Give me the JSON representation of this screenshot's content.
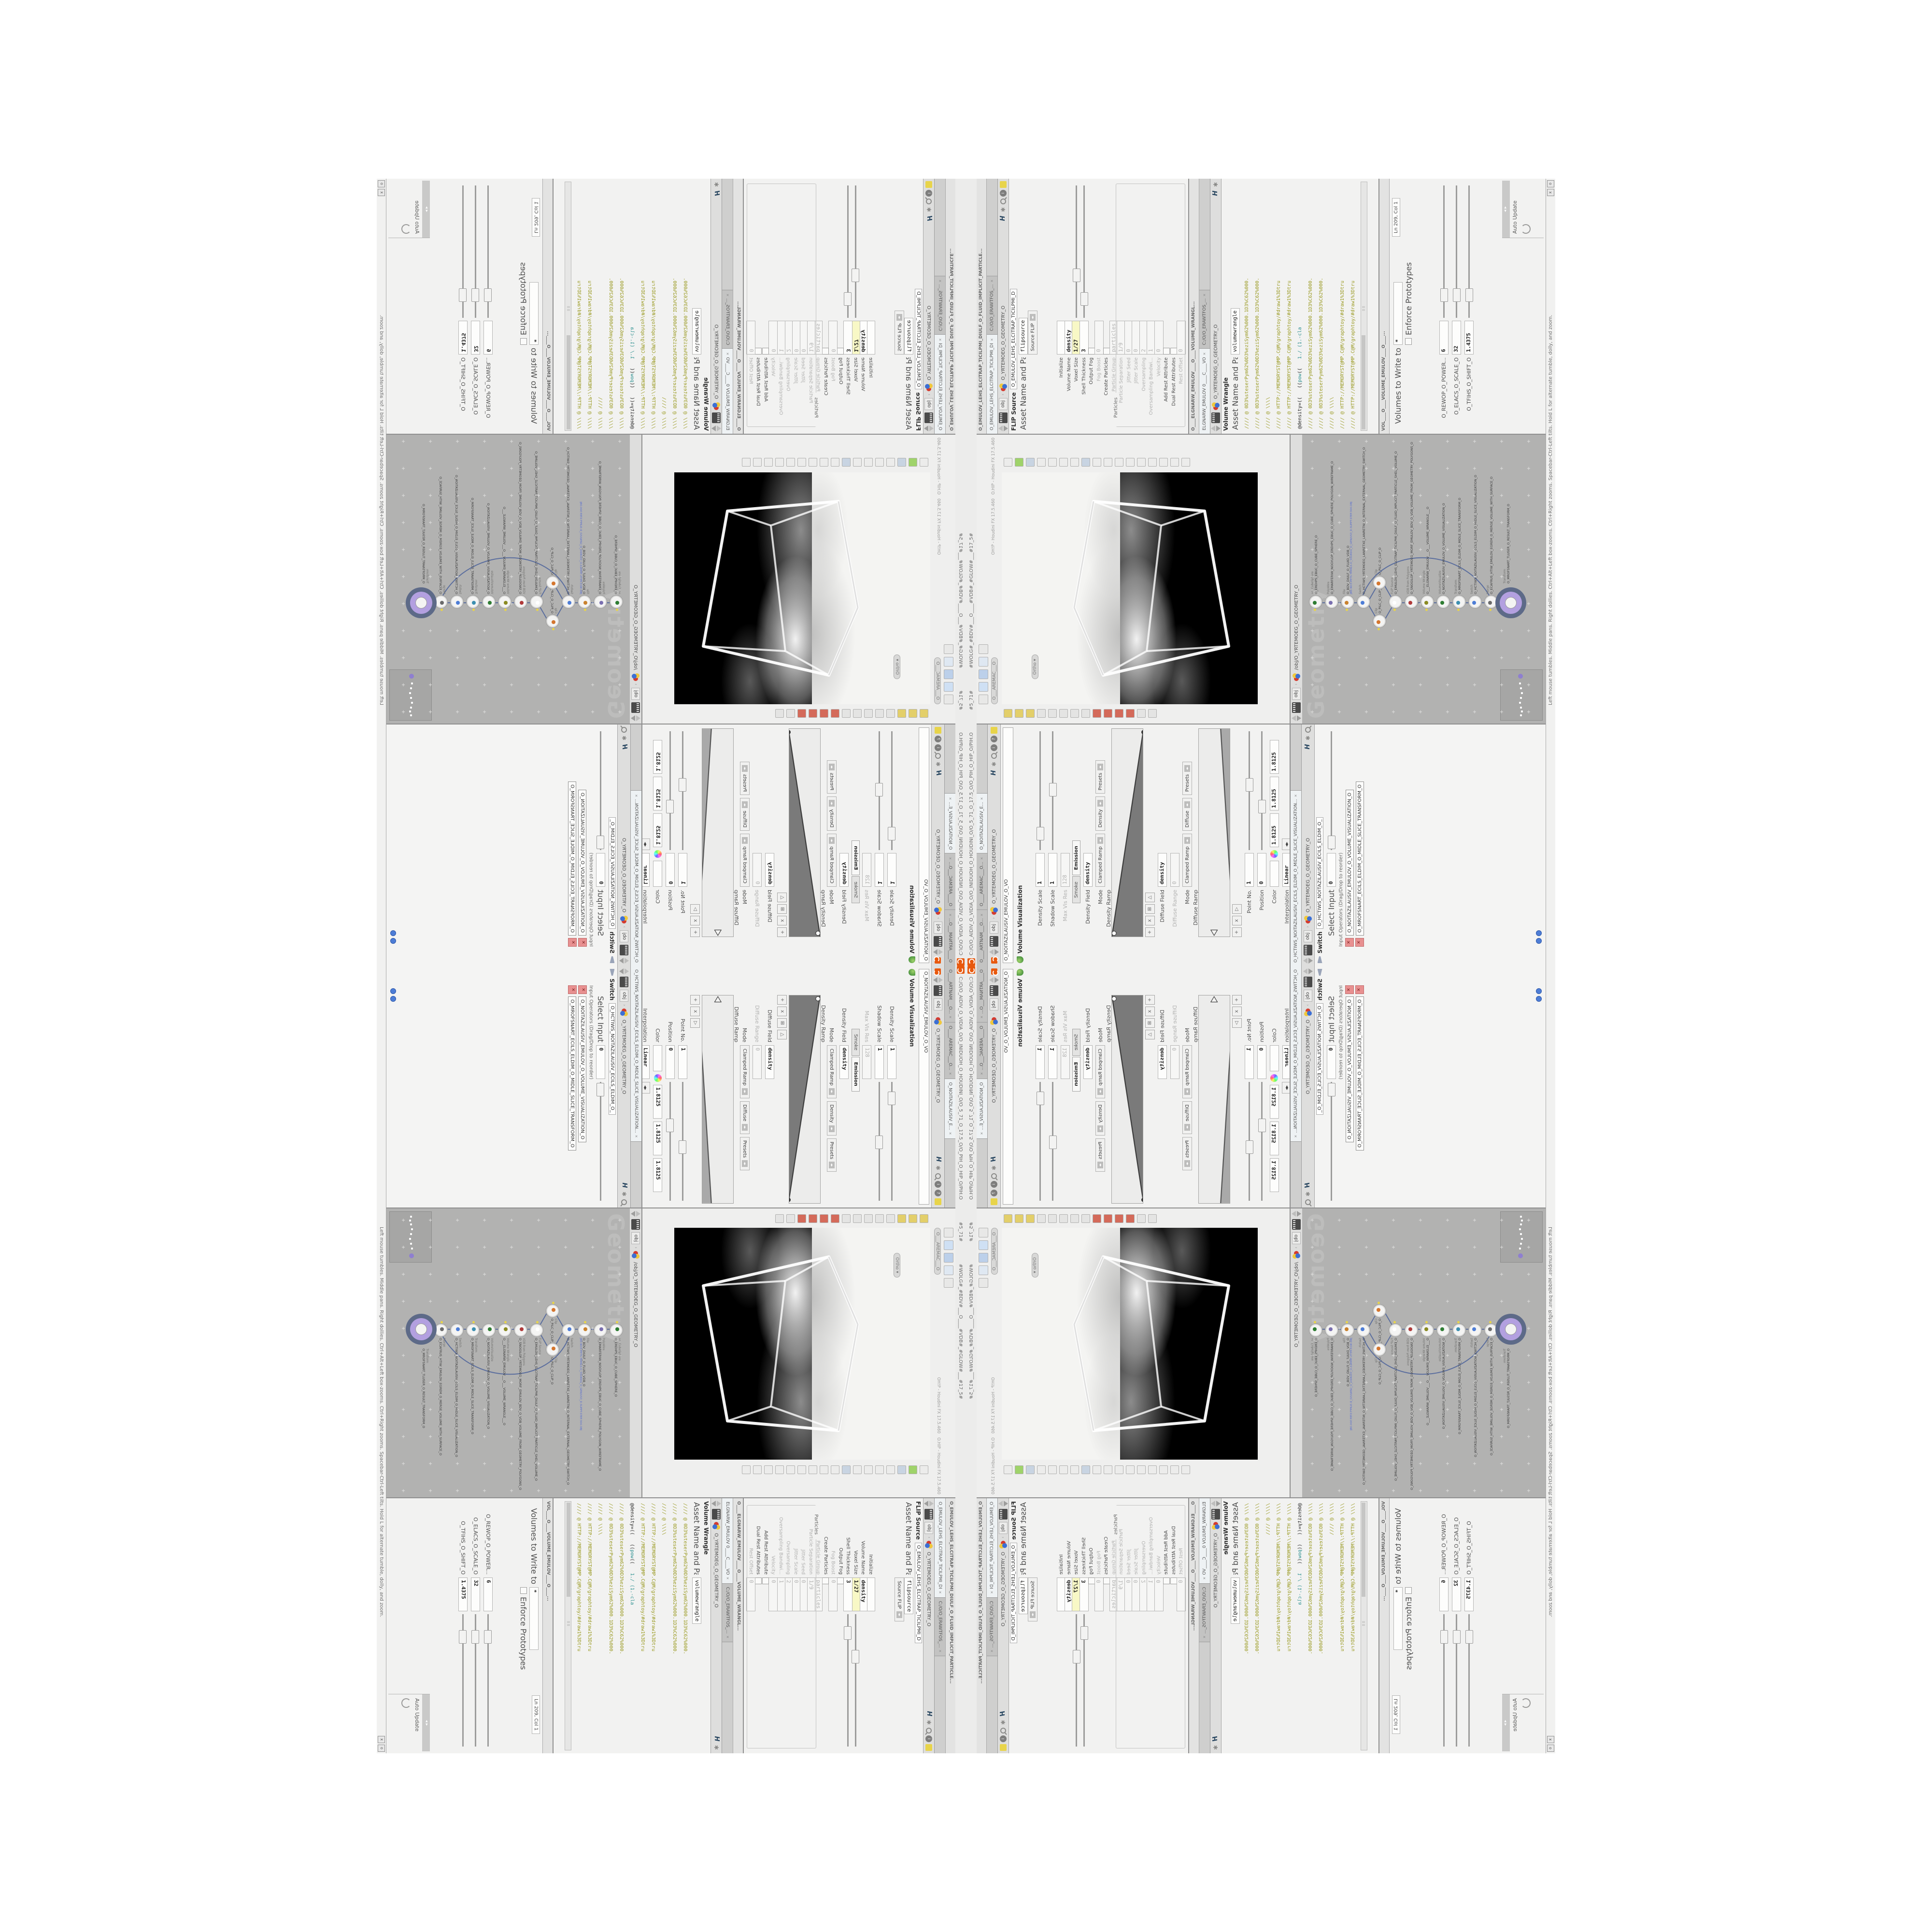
{
  "title_bar": {
    "path": "C:/O/O_AIDIV_O_VIDIA_O/O_INIDUOH_O_HOUDINI_O/O_5_71_O_17.5_O/O_PIH_O_HIP_O/PIH.O",
    "frame_tag": "#5_71#",
    "flags_tag": "#WOLG#_#BDV#___O____#VDB#_#GLOW#___#17_5#"
  },
  "status_bar": {
    "help_text": "Left mouse tumbles. Middle pans. Right dollies. Ctrl+Alt+Left box-zooms. Ctrl+Right zooms. Spacebar-Ctrl-Left tilts. Hold L for alternate tumble, dolly, and zoom.",
    "close_label": "x",
    "restore_label": "o"
  },
  "viz_pane": {
    "tabs": [
      "O____ARTNAM___O...",
      "O____AREMAC___O...",
      "O_NOITAZILAUSIV_E..."
    ],
    "path_context": "obj",
    "path_node": "O_YRTEMOEG_O_GEOMETRY_O",
    "name_field": "O_NOITAZILAUSIV_EMULOV_O_VO",
    "header": "Volume Visualization",
    "rows": [
      {
        "label": "Density Scale",
        "value": "1",
        "type": "slider"
      },
      {
        "label": "Shadow Scale",
        "value": "1",
        "type": "slider"
      },
      {
        "label": "Max Vis Res",
        "value": "128",
        "type": "dim"
      },
      {
        "label": "",
        "type": "tabs",
        "tabs": [
          "Smoke",
          "Emission"
        ],
        "active": 1
      },
      {
        "label": "Density Field",
        "value": "density",
        "type": "value"
      },
      {
        "label": "Mode",
        "type": "mode",
        "opts": [
          "Clamped Ramp",
          "Density",
          "Presets"
        ]
      },
      {
        "label": "Density Ramp",
        "type": "ramp",
        "ramp": "density"
      },
      {
        "label": "",
        "type": "btns",
        "btns": [
          "+",
          "x",
          "⊞",
          "△"
        ]
      },
      {
        "label": "Diffuse Field",
        "value": "density",
        "type": "value"
      },
      {
        "label": "Diffuse Range",
        "value": "0",
        "type": "dim"
      },
      {
        "label": "Mode",
        "type": "mode",
        "opts": [
          "Clamped Ramp",
          "Diffuse",
          "Presets"
        ]
      },
      {
        "label": "Diffuse Ramp",
        "type": "ramp",
        "ramp": "diffuse"
      },
      {
        "label": "",
        "type": "btns",
        "btns": [
          "+",
          "x",
          "▷"
        ]
      },
      {
        "label": "Point No.",
        "value": "1",
        "type": "slider"
      },
      {
        "label": "Position",
        "value": "0",
        "type": "slider"
      },
      {
        "label": "Color",
        "type": "color",
        "rgb": [
          "1.8125",
          "1.8125",
          "1.8125"
        ]
      },
      {
        "label": "Interpolation",
        "value": "Linear",
        "type": "dropdown"
      }
    ]
  },
  "switch_pane": {
    "tab": "O_HCTIWS_NOITAZILAUSIV_ECILS_ELDIM_O_MIDLE_SLICE_VISUALIZATION...",
    "path_context": "obj",
    "path_node": "O_YRTEMOEG_O_GEOMETRY_O",
    "header": "Switch",
    "name_field": "O_HCTIWS_NOITAZILAUSIV_ECILS_ELDIM_O_",
    "select_input_label": "Select Input",
    "select_input_value": "0",
    "input_operators_label": "Input Operators (Drag/Drop to reorder)",
    "items": [
      "O_NOITAZILAUSIV_EMULOV_O_VOLUME_VISUALIZATION_O",
      "O_MROFSNART_ECILS_ELDIM_O_MIDLE_SLICE_TRANSFORM_O"
    ]
  },
  "viewport": {
    "camera_pill": "O___AREMAC___O",
    "projection_pill": "Ortho",
    "hud_line_1": "OH!P - Houdini FX 17.5.460",
    "hud_line_2": "O.HIP - Houdini FX 17.5.460"
  },
  "network": {
    "path": "/obj/O_YRTEMOEG_O_GEOMETRY_O",
    "context_badge": "obj",
    "watermark": "Geometry",
    "nodes": [
      {
        "type": "an_CubeSphere",
        "name": "O_EREHPS_EBUC_O_CUBE_SPHERE_O",
        "glyph": "#2e7d32"
      },
      {
        "type": "PolyWire",
        "name": "O_EMARFERIW_NOGYLOP_EREHPS_EBUC_O_CUBE_SPHERE_POLYGON_WIREFRAME_O",
        "glyph": "#7a6fb0"
      },
      {
        "type": "File",
        "name": "O_BDV_DIULF_O_FLUID_VDB_O",
        "sub": "JBD.NO3.PETS.TRPALS.O_5SURDG_O_GEN/US3_D.SUPPT.STEP.304.OBJ",
        "glyph": "#c9822f"
      },
      {
        "type": "Switch",
        "name": "O_HCTIWS_YRTEMOEG_LANRETXE_LANRETNI_O_INTERNAL_EXTERNAL_GEOMETRY_SWITCH_O",
        "glyph": "#4d7dd6"
      },
      {
        "type": "Clip",
        "name": "O_PILC_O_CLIP_O",
        "glyph": "#d4762f"
      },
      {
        "type": "Clip",
        "name": "O_PILC_O_CLIP_O",
        "glyph": "#d4762f"
      },
      {
        "type": "FLIP Source",
        "name": "O_EMULOV_LEHS_ELCITRAP_TICILPMI_DIULF_O_FLUID_IMPLICIT_PARTICLE_SHEL_VOLUME_O",
        "glyph": "#ffffff"
      },
      {
        "type": "VDB from Polygons",
        "name": "O_SNOGILOP_YRTEMOEG_MORF_EMULOV_BDV_O_VDB_VOLUME_FROM_GEOMETRY_POLYGONS_O",
        "glyph": "#b03a3a"
      },
      {
        "type": "Volume Wrangle",
        "name": "O___ELGNARW_EMULOV___O___VOLUME_WRANGLE___O",
        "glyph": "#8a8a22"
      },
      {
        "type": "VolumeVisualize",
        "name": "O_NOITAZILAUSIV_EMULOV_O_VOLUME_VISUALIZATION_O",
        "glyph": "#2e7d32"
      },
      {
        "type": "Transform",
        "name": "O_MROFSNART_ECILS_ELDIM_O_MIDLE_SLICE_TRANSFORM_O",
        "glyph": "#3c8fb0"
      },
      {
        "type": "Switch",
        "name": "O_HCTIWS_NOITAZILAUSIV_ECILS_ELDIM_O_MIDLE_SLICE_VISUALIZATION_O",
        "glyph": "#4d7dd6"
      },
      {
        "type": "Merge",
        "name": "O_ECAFRUS_HTIW_EMULOV_EGREM_O_MERGE_VOLUME_WITH_SURFACE_O",
        "glyph": "#6a6a6a"
      },
      {
        "type": "Transform",
        "name": "O_MROFSNART_TLUSER_O_RESULT_TRANSFORM_O",
        "glyph": "#3c8fb0",
        "selected": true
      }
    ]
  },
  "flip_pane": {
    "window_title": "O_EMULOV_LEHS_ELCITRAP_TICILPMI_DIULF_O_FLUID_IMPLICIT_PARTICLE...",
    "tab1": "O_EMULOV_LEHS_ELCITRAP_TICILPMI_DI",
    "tab2": "C:/O/O_ERAWTFOS_...",
    "path_context": "obj",
    "path_node": "O_YRTEMOEG_O_GEOMETRY_O",
    "header": "FLIP Source",
    "header_field": "O_EMULOV_LEHS_ELCITRAP_TICILPMI_D",
    "asset_label": "Asset Name and Path",
    "asset_value": "flipsource",
    "preset_button": "Source FLIP",
    "rows": [
      {
        "label": "Initialize",
        "value": "",
        "type": "value"
      },
      {
        "label": "Volume Name",
        "value": "density",
        "type": "value"
      },
      {
        "label": "Voxel Size",
        "value": "1/27",
        "type": "yellow"
      },
      {
        "label": "Shell Thickness",
        "value": "3",
        "type": "slider"
      },
      {
        "label": "Output Fog",
        "type": "check"
      },
      {
        "label": "Fog Boost",
        "value": "0",
        "type": "dim"
      },
      {
        "label": "Create Particles",
        "type": "check"
      },
      {
        "label": "Particle Group",
        "value": "particles",
        "type": "dim"
      },
      {
        "label": "Particle Separation",
        "value": "1/9",
        "type": "dim"
      },
      {
        "label": "Jitter Seed",
        "value": "0",
        "type": "dim"
      },
      {
        "label": "Jitter Scale",
        "value": "0",
        "type": "dim"
      },
      {
        "label": "Oversampling",
        "value": "2",
        "type": "dim"
      },
      {
        "label": "Oversampling Bandwi...",
        "value": "1",
        "type": "dim"
      },
      {
        "label": "Velocity",
        "value": "0",
        "type": "dim"
      },
      {
        "label": "Add Rest Attribute",
        "type": "check"
      },
      {
        "label": "Dual Rest Attributes",
        "type": "check"
      },
      {
        "label": "Rest Offset",
        "value": "0",
        "type": "dim"
      }
    ],
    "group_label": "Particles"
  },
  "wrangle_pane": {
    "window_title": "O____ELGNARW_EMULOV____O____VOLUME_WRANGL...",
    "tab1": "ELGNARW_EMULOV 0____C____VO",
    "tab2": "C:/O/O_ERAWTFOS_...",
    "path_node": "O_YRTEMOEG_O_GEOMETRY_O",
    "header": "Volume Wrangle",
    "asset_label": "Asset Name and Path",
    "asset_value": "volumewrangle",
    "code_lines": [
      "//// @ 0D3%steserPym62%0D3%eziSym62%000.1D3%C62%000.",
      "//// @ 0D3%steserPym62%0D3%eziSym62%000.1D3%C62%000.",
      "//// @ \\\\\\\\",
      "//// @ HTTP://MEMORYST@MP.C@M/graphtoy/#draw1%3Dtru",
      "//// @ HTTP://MEMORYST@MP.C@M/graphtoy/#draw1%3Dtru",
      "@density=((   ((pow((   1./ (1.-cla",
      "//// @ 0D3%steserPym62%0D3%eziSym62%000.1D3%C62%000.",
      "//// @ 0D3%steserPym62%0D3%eziSym62%000.1D3%C62%000.",
      "//// @ \\\\\\\\",
      "//// @ HTTP://MEMORYST@MP.C@M/graphtoy/#draw1%3Dtru",
      "//// @ HTTP://MEMORYST@MP.C@M/graphtoy/#draw1%3Dtru"
    ]
  },
  "textport_pane": {
    "window_title": "VOL____O____VOLUME_EMULOV____O____...",
    "volumes_label": "Volumes to Write to",
    "volumes_value": "*",
    "enforce_label": "Enforce Prototypes",
    "cursor_status": "Ln 209, Col 1",
    "sliders": [
      {
        "label": "O_REWOP_O_POWER...",
        "value": "6"
      },
      {
        "label": "O_ELACS_O_SCALE_O",
        "value": "32"
      },
      {
        "label": "O_TFIHS_O_SHIFT_O",
        "value": "1.4375"
      }
    ],
    "auto_update_label": "Auto Update"
  },
  "colors": {
    "accent_orange": "#e8590e",
    "node_select_purple": "#b3a0e0",
    "node_ring_slate": "#5d6a88",
    "wire_blue": "#5b6e9e",
    "code_olive": "#9a9a22",
    "code_teal": "#2a8f8f",
    "value_yellow": "#f8f8c6",
    "network_gray": "#b2b2b1",
    "render_black": "#000000"
  }
}
